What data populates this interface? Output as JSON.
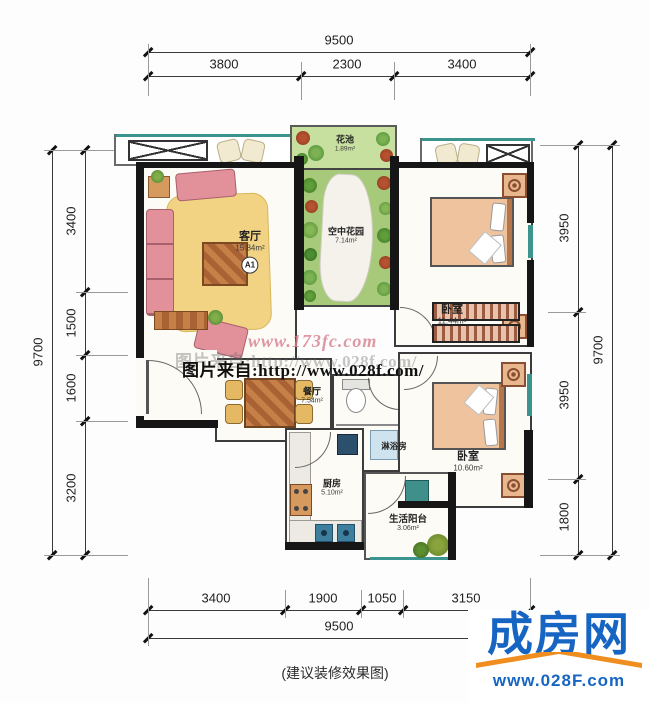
{
  "dimensions": {
    "top": {
      "total": "9500",
      "segments": [
        "3800",
        "2300",
        "3400"
      ]
    },
    "bottom": {
      "total": "9500",
      "segments": [
        "3400",
        "1900",
        "1050",
        "3150"
      ]
    },
    "left": {
      "total": "9700",
      "segments": [
        "3400",
        "1500",
        "1600",
        "3200"
      ]
    },
    "right": {
      "total": "9700",
      "segments": [
        "3950",
        "3950",
        "1800"
      ]
    }
  },
  "rooms": {
    "living": {
      "name": "客厅",
      "area": "15.84m²",
      "badge": "A1"
    },
    "flower_bed": {
      "name": "花池",
      "area": "1.89m²"
    },
    "sky_garden": {
      "name": "空中花园",
      "area": "7.14m²"
    },
    "bedroom_top": {
      "name": "卧室",
      "area": "11.44m²"
    },
    "dining": {
      "name": "餐厅",
      "area": "7.54m²"
    },
    "shower": {
      "name": "淋浴房"
    },
    "bedroom_bottom": {
      "name": "卧室",
      "area": "10.60m²"
    },
    "kitchen": {
      "name": "厨房",
      "area": "5.10m²"
    },
    "balcony": {
      "name": "生活阳台",
      "area": "3.06m²"
    }
  },
  "watermark": {
    "site": "www.173fc.com",
    "source": "图片来自:http://www.028f.com/"
  },
  "caption": "(建议装修效果图)",
  "logo": {
    "name": "成房网",
    "url": "www.028F.com"
  },
  "colors": {
    "wall": "#161616",
    "window_teal": "#3b948e",
    "garden_green": "#a6ca7a",
    "sofa_pink": "#e2909a",
    "wood": "#c67f47",
    "rug_yellow": "#f1d383",
    "logo_blue": "#1765c2",
    "logo_orange": "#ef8d1e",
    "watermark_pink": "#d67d8c"
  }
}
